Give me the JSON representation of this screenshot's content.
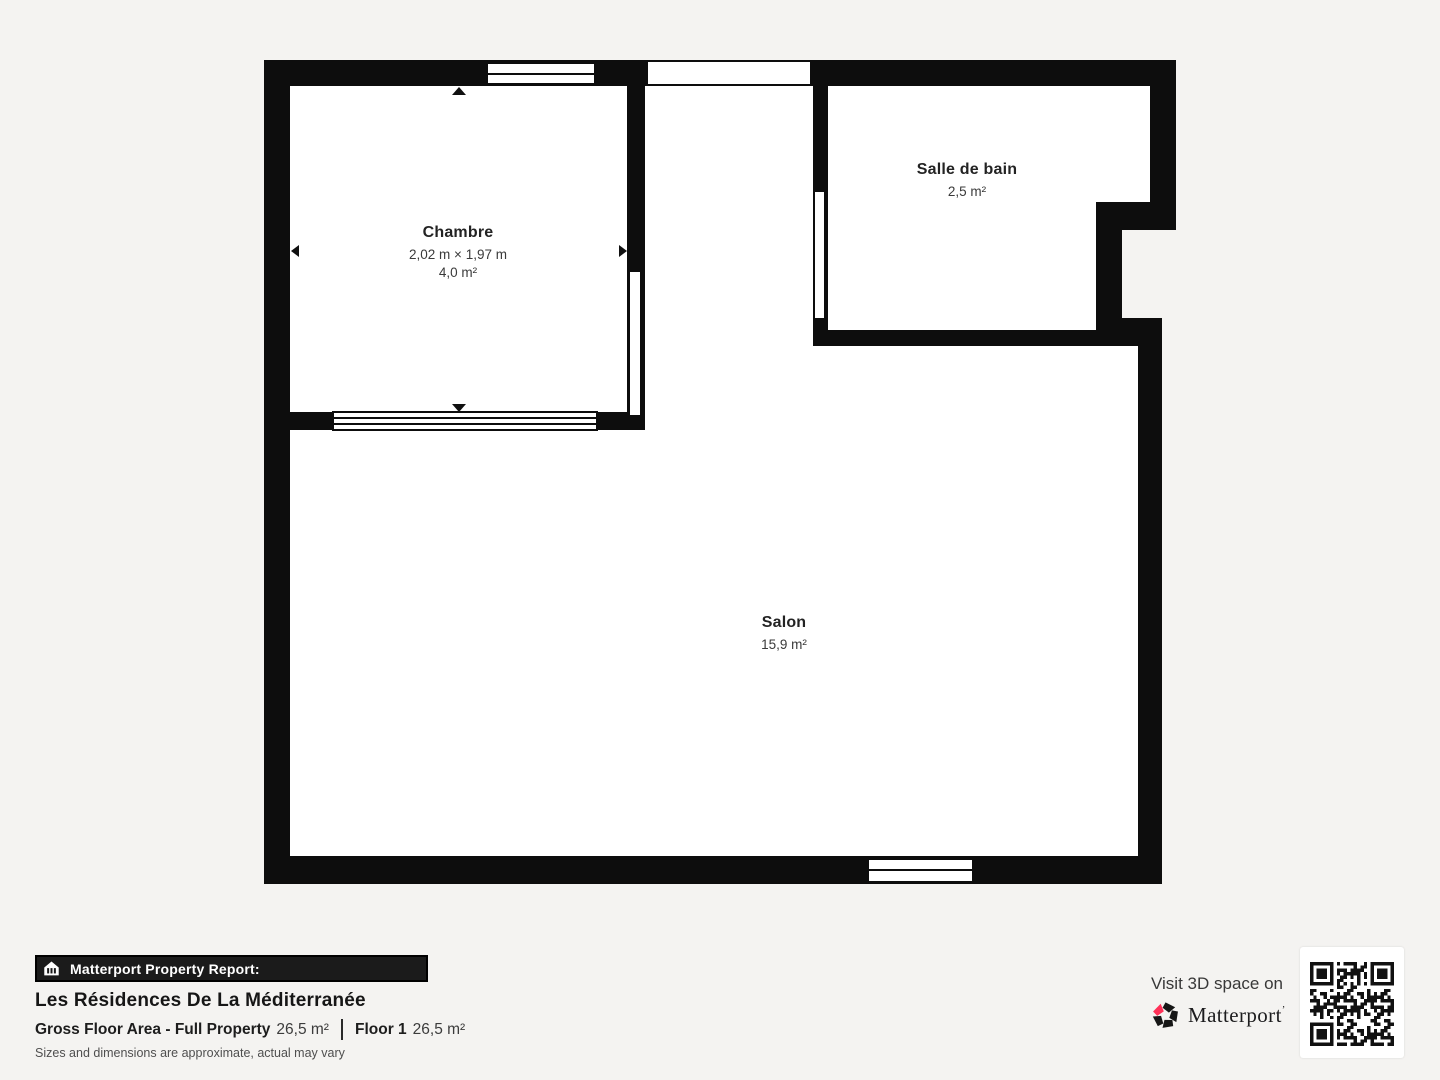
{
  "page": {
    "background_color": "#f4f3f1",
    "wall_color": "#0d0d0d",
    "interior_color": "#ffffff"
  },
  "floorplan": {
    "rooms": [
      {
        "id": "chambre",
        "name": "Chambre",
        "dimensions": "2,02 m × 1,97 m",
        "area": "4,0 m²"
      },
      {
        "id": "salle-de-bain",
        "name": "Salle de bain",
        "area": "2,5 m²"
      },
      {
        "id": "salon",
        "name": "Salon",
        "area": "15,9 m²"
      }
    ]
  },
  "footer": {
    "banner": {
      "icon": "building-icon",
      "label": "Matterport Property Report:"
    },
    "property_name": "Les Résidences De La Méditerranée",
    "gross_floor_area_label": "Gross Floor Area - Full Property",
    "gross_floor_area_value": "26,5 m²",
    "floor_label": "Floor 1",
    "floor_value": "26,5 m²",
    "disclaimer": "Sizes and dimensions are approximate, actual may vary"
  },
  "cta": {
    "visit_text": "Visit 3D space on",
    "brand": "Matterport",
    "brand_tick": "’",
    "brand_accent_color": "#ff3158",
    "qr": "qr-code"
  }
}
